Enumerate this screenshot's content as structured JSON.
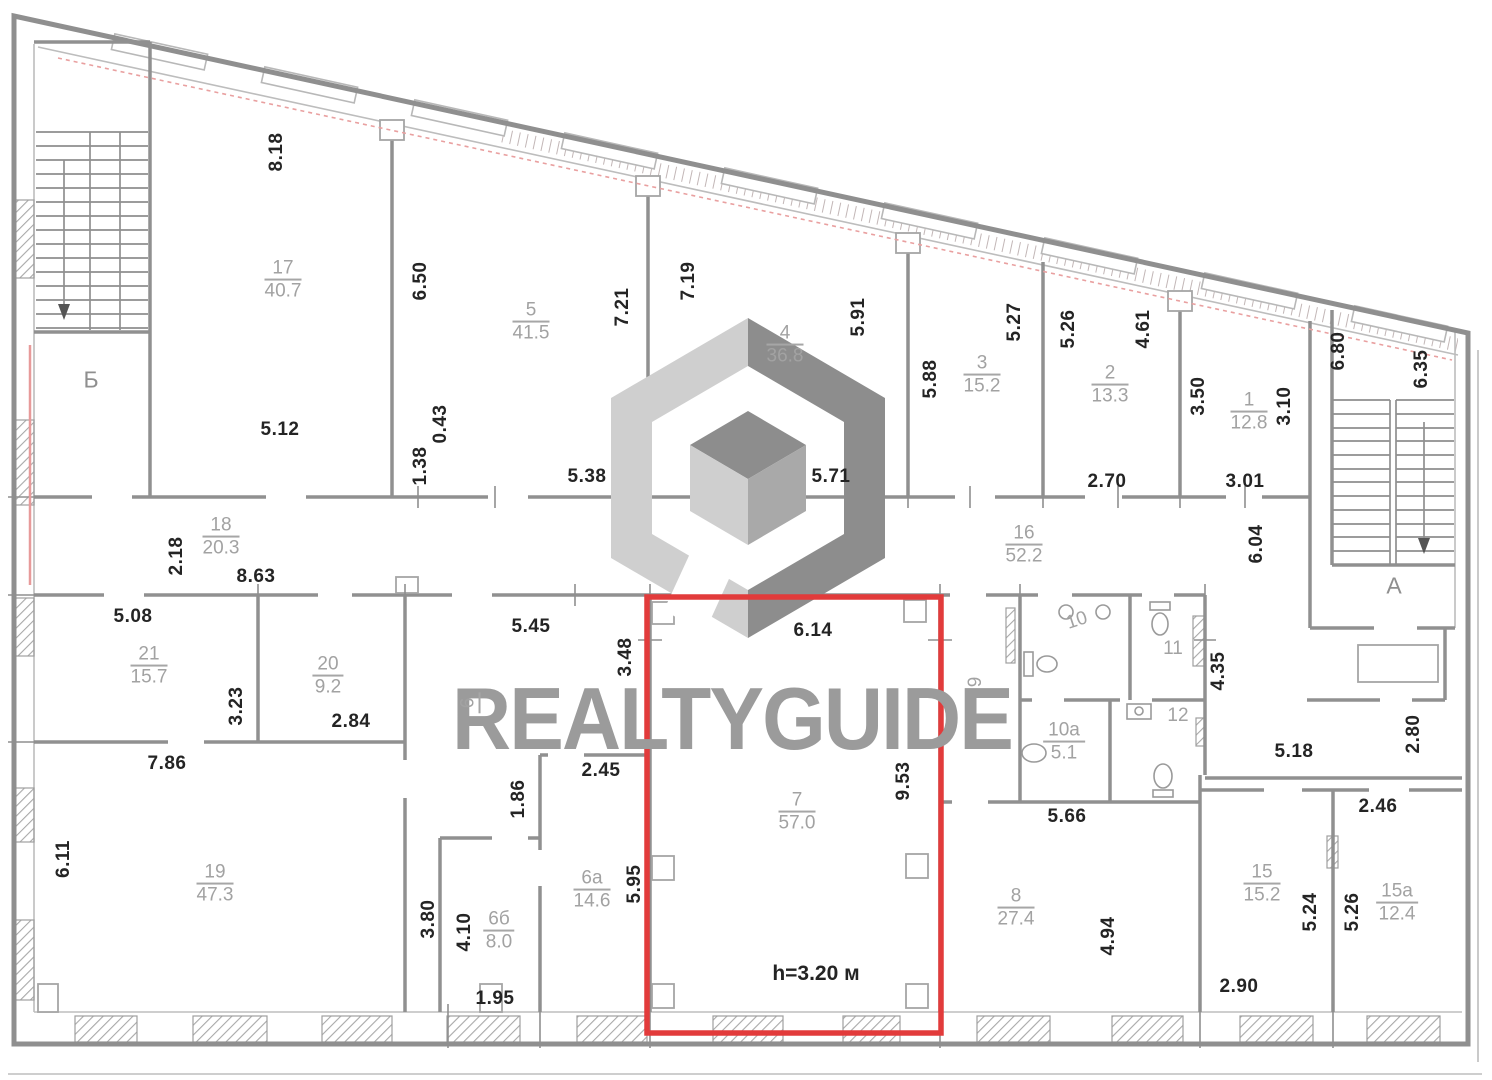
{
  "watermark": {
    "text": "REALTYGUIDE"
  },
  "highlight": {
    "room": "7",
    "color": "#e23b3b",
    "height_note": "h=3.20 м"
  },
  "stairwells": {
    "left": "Б",
    "right": "А"
  },
  "rooms": {
    "r17": {
      "num": "17",
      "area": "40.7"
    },
    "r5": {
      "num": "5",
      "area": "41.5"
    },
    "r4": {
      "num": "4",
      "area": "36.8"
    },
    "r3": {
      "num": "3",
      "area": "15.2"
    },
    "r2": {
      "num": "2",
      "area": "13.3"
    },
    "r1": {
      "num": "1",
      "area": "12.8"
    },
    "r18": {
      "num": "18",
      "area": "20.3"
    },
    "r16": {
      "num": "16",
      "area": "52.2"
    },
    "r21": {
      "num": "21",
      "area": "15.7"
    },
    "r20": {
      "num": "20",
      "area": "9.2"
    },
    "r19": {
      "num": "19",
      "area": "47.3"
    },
    "r6": {
      "num": "6",
      "area": ""
    },
    "r6a": {
      "num": "6а",
      "area": "14.6"
    },
    "r6b": {
      "num": "6б",
      "area": "8.0"
    },
    "r7": {
      "num": "7",
      "area": "57.0"
    },
    "r8": {
      "num": "8",
      "area": "27.4"
    },
    "r9": {
      "num": "9",
      "area": ""
    },
    "r10": {
      "num": "10",
      "area": ""
    },
    "r10a": {
      "num": "10а",
      "area": "5.1"
    },
    "r11": {
      "num": "11",
      "area": ""
    },
    "r12": {
      "num": "12",
      "area": ""
    },
    "r15": {
      "num": "15",
      "area": "15.2"
    },
    "r15a": {
      "num": "15а",
      "area": "12.4"
    }
  },
  "dims": [
    "8.18",
    "6.50",
    "5.12",
    "0.43",
    "1.38",
    "5.38",
    "7.21",
    "7.19",
    "5.91",
    "5.88",
    "5.71",
    "5.27",
    "5.26",
    "4.61",
    "2.70",
    "3.50",
    "3.10",
    "3.01",
    "6.80",
    "6.35",
    "2.18",
    "8.63",
    "6.04",
    "5.08",
    "3.23",
    "2.84",
    "7.86",
    "6.11",
    "5.45",
    "3.48",
    "1.86",
    "2.45",
    "6.14",
    "9.53",
    "5.95",
    "3.80",
    "4.10",
    "1.95",
    "4.35",
    "5.66",
    "4.94",
    "5.18",
    "2.80",
    "2.46",
    "5.24",
    "5.26",
    "2.90"
  ]
}
